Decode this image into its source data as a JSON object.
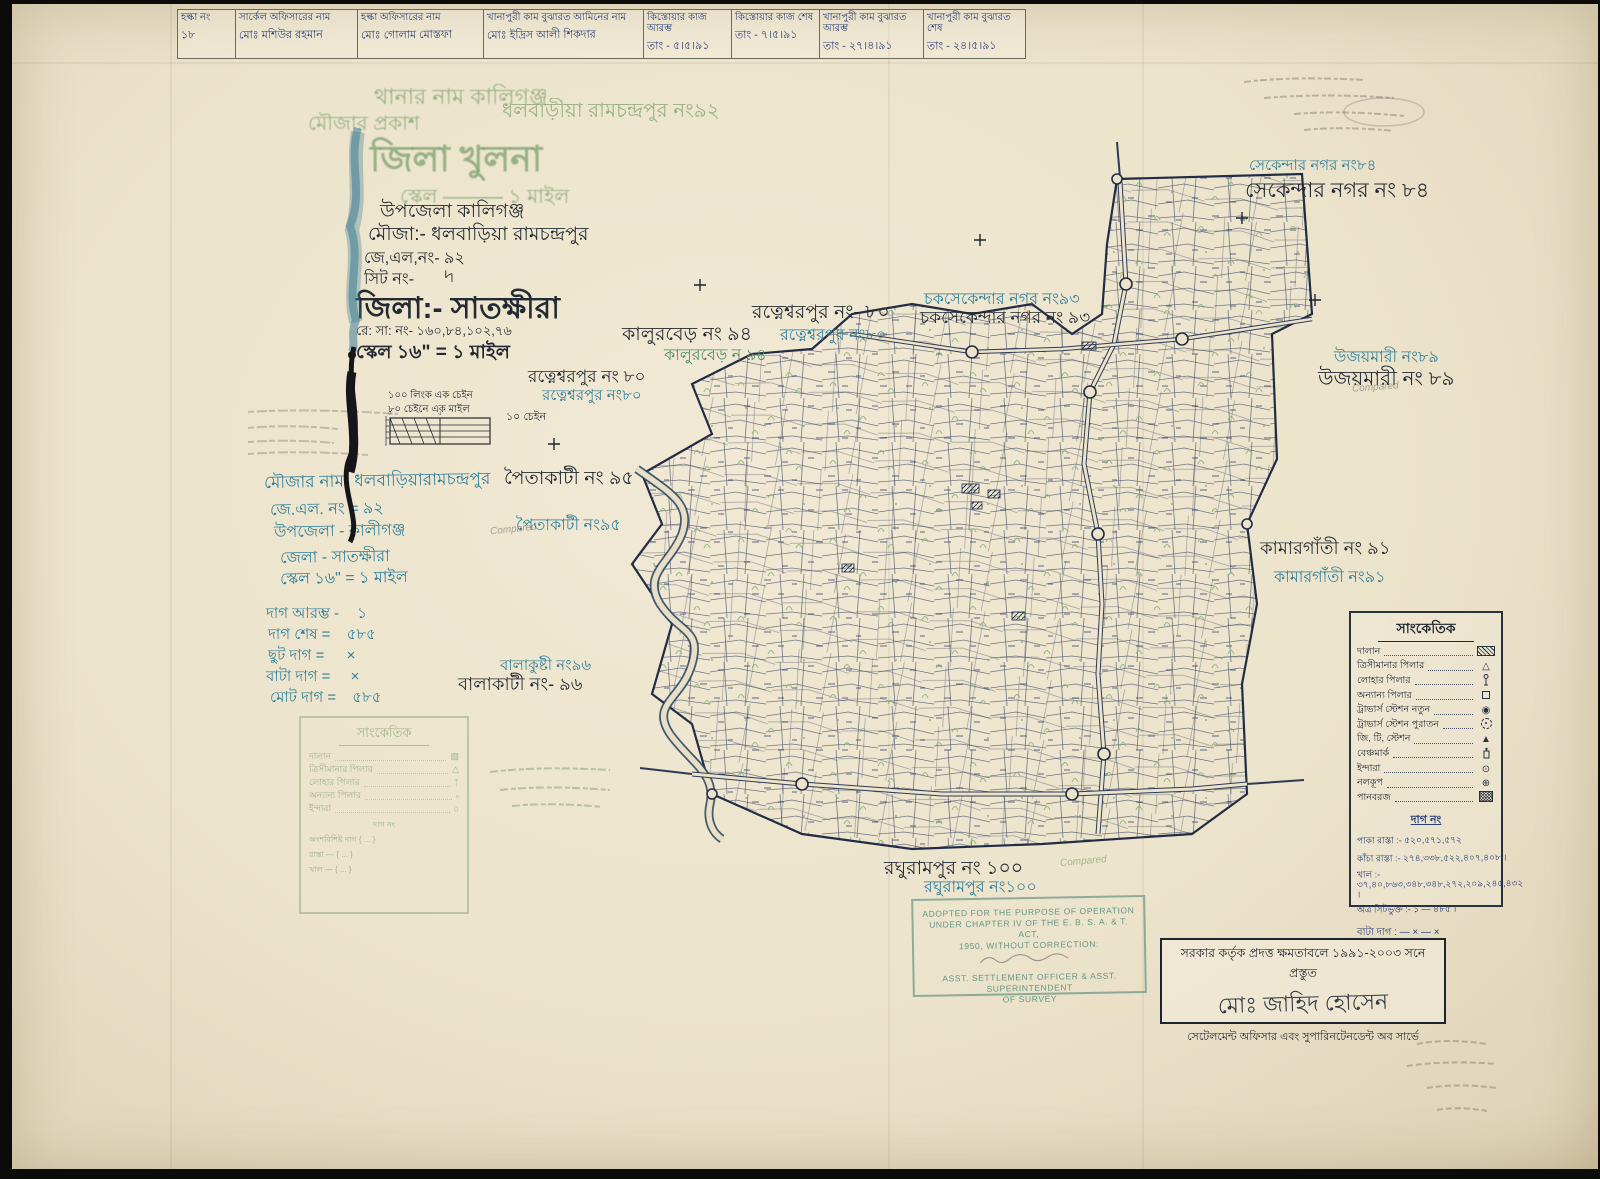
{
  "header_table": {
    "columns": [
      {
        "label": "হল্কা নং",
        "value": "১৮"
      },
      {
        "label": "সার্কেল অফিসারের নাম",
        "value": "মোঃ মশিউর রহমান"
      },
      {
        "label": "হল্কা অফিসারের নাম",
        "value": "মোঃ গোলাম মোস্তফা"
      },
      {
        "label": "খানাপুরী কাম বুঝারত আমিনের নাম",
        "value": "মোঃ ইদ্রিস আলী শিকদার"
      },
      {
        "label": "কিস্তোয়ার কাজ আরম্ভ",
        "value": "তাং - ৫।৫।৯১"
      },
      {
        "label": "কিস্তোয়ার কাজ শেষ",
        "value": "তাং - ৭।৫।৯১"
      },
      {
        "label": "খানাপুরী কাম বুঝারত আরম্ভ",
        "value": "তাং - ২৭।৪।৯১"
      },
      {
        "label": "খানাপুরী কাম বুঝারত শেষ",
        "value": "তাং - ২৪।৫।৯১"
      }
    ]
  },
  "green_stamp": {
    "thana": "থানার নাম কালিগঞ্জ",
    "mouza_prefix": "মৌজার প্রকাশ",
    "mouza_name": "ধলবাড়ীয়া রামচন্দ্রপুর নং৯২",
    "district": "জিলা  খুলনা",
    "scale": "স্কেল ——— ১ মাইল"
  },
  "ink_title": {
    "upazila": "উপজেলা কালিগঞ্জ",
    "mouza": "মৌজা:- ধলবাড়িয়া রামচন্দ্রপুর",
    "jl": "জে,এল,নং-  ৯২",
    "sheet": "সিট নং-",
    "sheet_mark": "৸",
    "district": "জিলা:- সাতক্ষীরা",
    "rs": "রে: সা: নং- ১৬০,৮৪,১০২,৭৬",
    "scale": "স্কেল ১৬ʺ = ১ মাইল",
    "chain_note_1": "১০০ লিংক এক চেইন",
    "chain_note_2": "৮০ চেইনে এক মাইল",
    "scalebar_label": "১০ চেইন"
  },
  "teal_info": {
    "rows": [
      "মৌজার নাম- ধলবাড়িয়ারামচন্দ্রপুর",
      "জে.এল. নং =  ৯২",
      "উপজেলা - কালীগঞ্জ",
      "জেলা - সাতক্ষীরা",
      "স্কেল ১৬ʺ = ১ মাইল"
    ]
  },
  "dag_summary": {
    "rows": [
      {
        "label": "দাগ আরম্ভ -",
        "value": "১"
      },
      {
        "label": "দাগ শেষ =",
        "value": "৫৮৫"
      },
      {
        "label": "ছুট দাগ =",
        "value": "×"
      },
      {
        "label": "বাটা দাগ =",
        "value": "×"
      },
      {
        "label": "মোট দাগ =",
        "value": "৫৮৫"
      }
    ]
  },
  "map_labels": {
    "sekandar_nagar": {
      "teal": "সেকেন্দার নগর নং৮৪",
      "black": "সেকেন্দার নগর নং ৮৪"
    },
    "chak_sekandar_nagar": {
      "teal": "চকসেকেন্দার নগর নং৯৩",
      "black": "চকসেকেন্দার নগর নং ৯৩"
    },
    "ratneshwarpur_upper": {
      "black": "রত্নেশ্বরপুর নং- ৮০",
      "teal": "রত্নেশ্বরপুর নং৮০"
    },
    "kalurber": {
      "black": "কালুরবেড় নং ৯৪",
      "green": "কালুরবেড় ন ৯৪"
    },
    "ratneshwarpur_left": {
      "black": "রত্নেশ্বরপুর নং ৮০",
      "teal": "রত্নেশ্বরপুর নং৮০"
    },
    "paitakati": {
      "black": "পৈতাকাটী নং ৯৫",
      "teal": "পৈতাকাটী নং৯৫"
    },
    "ujaymari": {
      "teal": "উজয়মারী নং৮৯",
      "black": "উজয়মারী নং ৮৯"
    },
    "kamargati": {
      "black": "কামারগাঁতী নং ৯১",
      "teal": "কামারগাঁতী নং৯১"
    },
    "balakati": {
      "teal": "বালাকুষ্টী নং৯৬",
      "black": "বালাকাটী নং- ৯৬"
    },
    "raghurampur": {
      "black": "রঘুরামপুর নং ১০০",
      "teal": "রঘুরামপুর নং১০০"
    }
  },
  "legend": {
    "title": "সাংকেতিক",
    "items": [
      {
        "label": "দালান",
        "symbol": "hatched-rect"
      },
      {
        "label": "ত্রিসীমানার পিলার",
        "symbol": "triangle"
      },
      {
        "label": "লোহার পিলার",
        "symbol": "iron-pillar"
      },
      {
        "label": "অন্যান্য পিলার",
        "symbol": "small-square"
      },
      {
        "label": "ট্রাভার্স স্টেশন নতুন",
        "symbol": "circle-dot"
      },
      {
        "label": "ট্রাভার্স স্টেশন পুরাতন",
        "symbol": "circle-dot-dashed"
      },
      {
        "label": "জি, টি, স্টেশন",
        "symbol": "triangle-dot"
      },
      {
        "label": "বেঞ্চমার্ক",
        "symbol": "benchmark"
      },
      {
        "label": "ইন্দারা",
        "symbol": "circle-small-dot"
      },
      {
        "label": "নলকূপ",
        "symbol": "circle-cross"
      },
      {
        "label": "পানবরজ",
        "symbol": "hatched-square"
      }
    ],
    "dag_heading": "দাগ নং",
    "dag_lines": [
      "পাকা রাস্তা :- ৫২০,৫৭১,৫৭২",
      "কাঁচা রাস্তা :- ২৭৪,৩৩৮,৫২২,৪০৭,৪০৮ ।",
      "খাল :- ৩৭,৪০,৮৬৩,৩৪৮,৩৪৮,২৭২,২০৯,২৪৫,৪৩২ ।",
      "অত্র সিটভুক্ত :- ১ — ৪৮৫ ।"
    ],
    "bata_line": "বাটা দাগ : — × — ×"
  },
  "legend_faded": {
    "title": "সাংকেতিক",
    "items": [
      "দালান",
      "ত্রিসীমানার পিলার",
      "লোহার পিলার",
      "অন্যান্য পিলার",
      "ইন্দারা"
    ],
    "extra": [
      "দাগ নং",
      "অংশবিশিষ্ট দাগ { ... }",
      "রাস্তা — { ... }",
      "খাল — { ... }"
    ]
  },
  "adopted_stamp": {
    "line1": "ADOPTED FOR THE PURPOSE OF OPERATION",
    "line2": "UNDER CHAPTER IV OF THE E. B. S. A. & T. ACT,",
    "line3": "1950, WITHOUT CORRECTION:",
    "line4": "ASST. SETTLEMENT OFFICER & ASST. SUPERINTENDENT",
    "line5": "OF SURVEY"
  },
  "authority_box": {
    "top": "সরকার কর্তৃক প্রদত্ত ক্ষমতাবলে ১৯৯১-২০০৩ সনে প্রস্তুত",
    "signature": "মোঃ জাহিদ হোসেন",
    "bottom": "সেটেলমেন্ট অফিসার এবং সুপারিনটেনডেন্ট অব সার্ভে"
  },
  "notes": {
    "compared": "Compared"
  },
  "colors": {
    "paper": "#ece3cb",
    "ink": "#232a33",
    "map_line": "#2e3a55",
    "teal": "#2f7f99",
    "green_stamp": "#79a06b",
    "pen_blue": "#2b3f78",
    "stamp_teal": "#57907f"
  }
}
